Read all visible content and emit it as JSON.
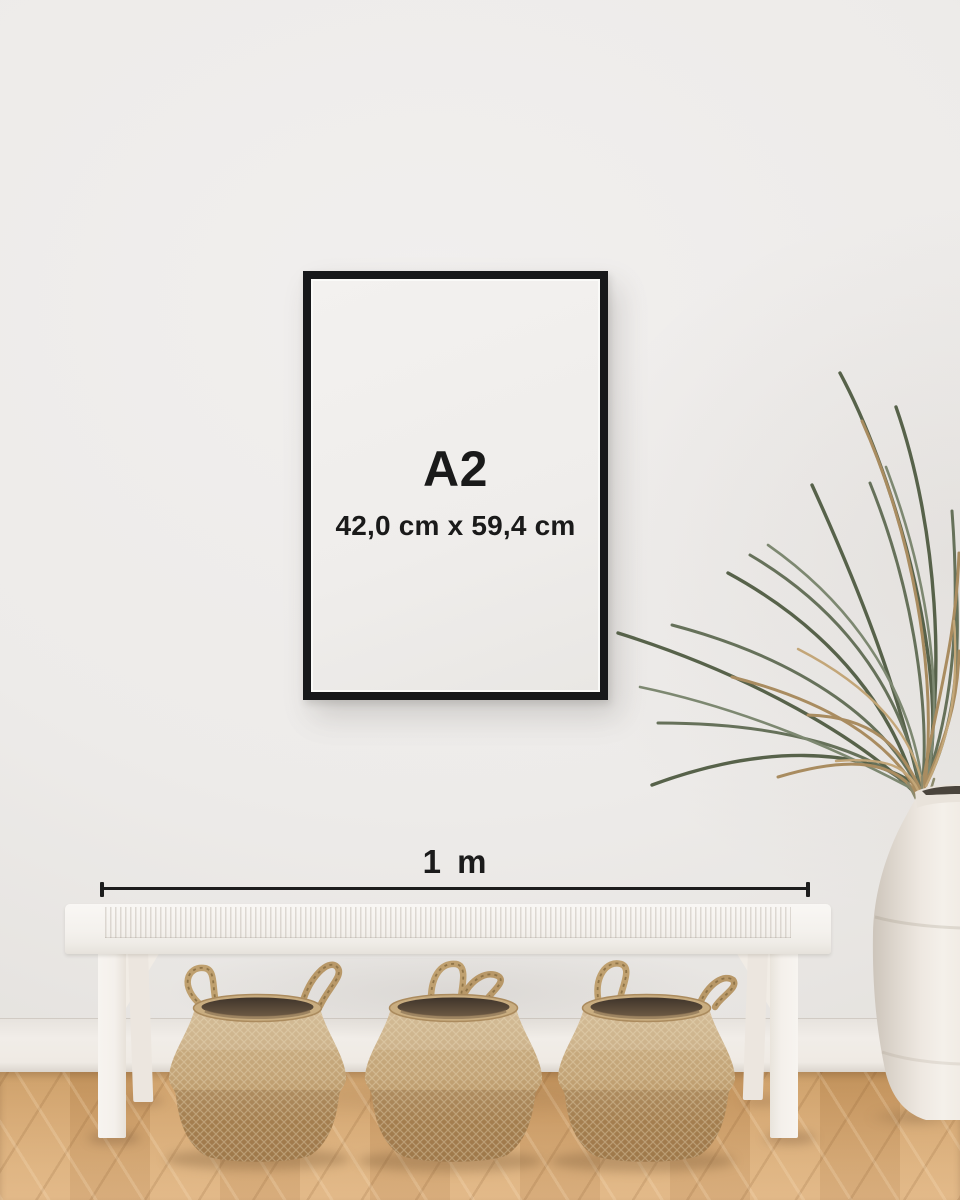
{
  "frame": {
    "size_label": "A2",
    "dimensions_label": "42,0 cm x 59,4 cm"
  },
  "ruler": {
    "label": "1 m"
  },
  "colors": {
    "frame_border": "#17181a",
    "frame_mat": "#f1efed",
    "label_text": "#1a1a1a",
    "ruler_line": "#1d1d1d",
    "wall": "#edebe9",
    "baseboard": "#f0ece7",
    "floor_wood": "#d0a26c",
    "bench_white": "#f6f3ef",
    "basket_tan": "#c2a278",
    "basket_interior": "#4a3c2d",
    "plant_green": "#57624a",
    "plant_dried": "#a98c60",
    "vase_cream": "#efeae3"
  }
}
